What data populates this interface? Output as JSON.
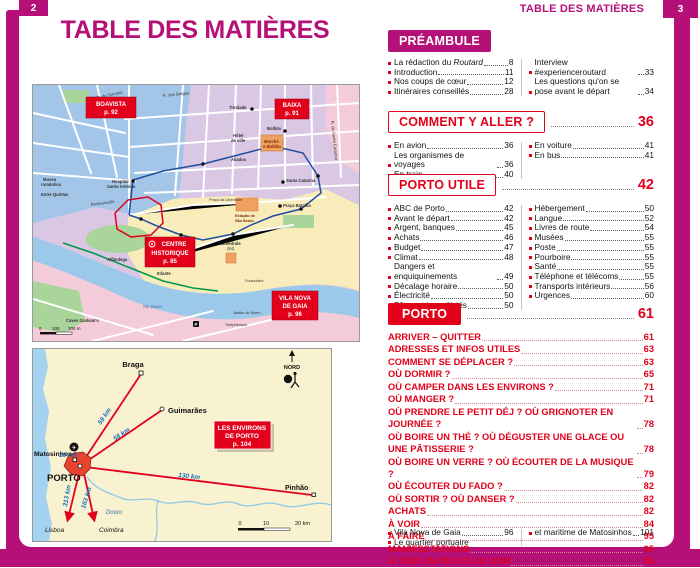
{
  "colors": {
    "magenta": "#b41078",
    "red": "#e2001b",
    "map_lilac": "#d9c7e3",
    "map_blue": "#a3c6e8",
    "map_yellow": "#f7ecba",
    "map_pink": "#f4cbd9",
    "map_green": "#a9d49a",
    "river_blue": "#9cc9ea",
    "region_cream": "#f8f2d0",
    "sea_blue": "#a5d2ee"
  },
  "page": {
    "tab_left": "2",
    "tab_right": "3",
    "header_right": "TABLE DES MATIÈRES",
    "title": "TABLE DES MATIÈRES"
  },
  "city_map": {
    "district_labels": [
      {
        "lines": [
          "BOAVISTA",
          "p. 92"
        ]
      },
      {
        "lines": [
          "BAIXA",
          "p. 91"
        ]
      },
      {
        "lines": [
          "CENTRE",
          "HISTORIQUE",
          "p. 85"
        ]
      },
      {
        "lines": [
          "VILA NOVA",
          "DE GAIA",
          "p. 96"
        ]
      }
    ],
    "streets": [
      "R. da Torrinha",
      "R. dos Bragas",
      "Trindade",
      "Bolhão",
      "Marché",
      "o Bolhão",
      "Hôtel",
      "de ville",
      "Aliados",
      "R. de Santa Catarina",
      "Praça da Liberdade",
      "Estação de",
      "São Bento",
      "Praça Batalha",
      "Santa Catarina",
      "Museu",
      "romântico",
      "Entre Quintas",
      "Hospital",
      "Santo António",
      "Restauração",
      "Alfândega",
      "Infante",
      "Cathédrale",
      "(84)",
      "Funiculaire",
      "Téléphérique",
      "Jardim do Morro",
      "Caves Graham's",
      "Rio Douro",
      "P"
    ],
    "scale": {
      "t0": "0",
      "t1": "100",
      "t2": "200 m"
    }
  },
  "region_map": {
    "north_label": "NORD",
    "box_lines": [
      "LES ENVIRONS",
      "DE PORTO",
      "p. 104"
    ],
    "towns": {
      "braga": "Braga",
      "guimaraes": "Guimarães",
      "matosinhos": "Matosinhos",
      "porto": "PORTO",
      "pinhao": "Pinhão",
      "lisboa": "Lisboa",
      "coimbra": "Coimbra"
    },
    "distances": {
      "braga": "58 km",
      "guimaraes": "58 km",
      "pinhao": "130 km",
      "lisboa": "313 km",
      "coimbra": "163 km",
      "airport": "10 km"
    },
    "airport_icon": "✈",
    "river": "Douro",
    "scale": {
      "t0": "0",
      "t1": "10",
      "t2": "20 km"
    }
  },
  "toc": {
    "preambule": {
      "title": "PRÉAMBULE",
      "left": [
        {
          "t": "La rédaction du ",
          "it": "Routard",
          "p": "8"
        },
        {
          "t": "Introduction",
          "p": "11"
        },
        {
          "t": "Nos coups de cœur",
          "p": "12"
        },
        {
          "t": "Itinéraires conseillés",
          "p": "28"
        }
      ],
      "right": [
        {
          "t": "Interview #experienceroutard",
          "p": "33"
        },
        {
          "t": "Les questions qu'on se pose avant le départ",
          "p": "34"
        }
      ]
    },
    "comment": {
      "title": "COMMENT Y ALLER ?",
      "page": "36",
      "left": [
        {
          "t": "En avion",
          "p": "36"
        },
        {
          "t": "Les organismes de voyages",
          "p": "36"
        },
        {
          "t": "En train",
          "p": "40"
        }
      ],
      "right": [
        {
          "t": "En voiture",
          "p": "41"
        },
        {
          "t": "En bus",
          "p": "41"
        }
      ]
    },
    "porto_utile": {
      "title": "PORTO UTILE",
      "page": "42",
      "left": [
        {
          "t": "ABC de Porto",
          "p": "42"
        },
        {
          "t": "Avant le départ",
          "p": "42"
        },
        {
          "t": "Argent, banques",
          "p": "45"
        },
        {
          "t": "Achats",
          "p": "46"
        },
        {
          "t": "Budget",
          "p": "47"
        },
        {
          "t": "Climat",
          "p": "48"
        },
        {
          "t": "Dangers et enquiquinements",
          "p": "49"
        },
        {
          "t": "Décalage horaire",
          "p": "50"
        },
        {
          "t": "Électricité",
          "p": "50"
        },
        {
          "t": "Fêtes et jours fériés",
          "p": "50"
        }
      ],
      "right": [
        {
          "t": "Hébergement",
          "p": "50"
        },
        {
          "t": "Langue",
          "p": "52"
        },
        {
          "t": "Livres de route",
          "p": "54"
        },
        {
          "t": "Musées",
          "p": "55"
        },
        {
          "t": "Poste",
          "p": "55"
        },
        {
          "t": "Pourboire",
          "p": "55"
        },
        {
          "t": "Santé",
          "p": "55"
        },
        {
          "t": "Téléphone et télécoms",
          "p": "55"
        },
        {
          "t": "Transports intérieurs",
          "p": "56"
        },
        {
          "t": "Urgences",
          "p": "60"
        }
      ]
    },
    "porto": {
      "title": "PORTO",
      "page": "61",
      "entries": [
        {
          "t": "ARRIVER – QUITTER",
          "p": "61"
        },
        {
          "t": "ADRESSES ET INFOS UTILES",
          "p": "63"
        },
        {
          "t": "COMMENT SE DÉPLACER ?",
          "p": "63"
        },
        {
          "t": "OÙ DORMIR ?",
          "p": "65"
        },
        {
          "t": "OÙ CAMPER DANS LES ENVIRONS ?",
          "p": "71"
        },
        {
          "t": "OÙ MANGER ?",
          "p": "71"
        },
        {
          "t": "OÙ PRENDRE LE PETIT DÉJ ? OÙ GRIGNOTER EN JOURNÉE ?",
          "p": "78"
        },
        {
          "t": "OÙ BOIRE UN THÉ ? OÙ DÉGUSTER UNE GLACE OU UNE PÂTISSERIE ?",
          "p": "78"
        },
        {
          "t": "OÙ BOIRE UN VERRE ? OÙ ÉCOUTER DE LA MUSIQUE ?",
          "p": "79"
        },
        {
          "t": "OÙ ÉCOUTER DU FADO ?",
          "p": "82"
        },
        {
          "t": "OÙ SORTIR ? OÙ DANSER ?",
          "p": "82"
        },
        {
          "t": "ACHATS",
          "p": "82"
        },
        {
          "t": "À VOIR",
          "p": "84"
        },
        {
          "t": "À FAIRE",
          "p": "95"
        },
        {
          "t": "MANIFESTATIONS",
          "p": "95"
        },
        {
          "t": "À VOIR UN PEU PLUS LOIN",
          "p": "96"
        }
      ],
      "sub_left": [
        {
          "t": "Vila Nova de Gaia",
          "p": "96"
        },
        {
          "t": "Le quartier portuaire",
          "p": ""
        }
      ],
      "sub_right": [
        {
          "t": "et maritime de Matosinhos",
          "p": "101"
        }
      ]
    }
  }
}
